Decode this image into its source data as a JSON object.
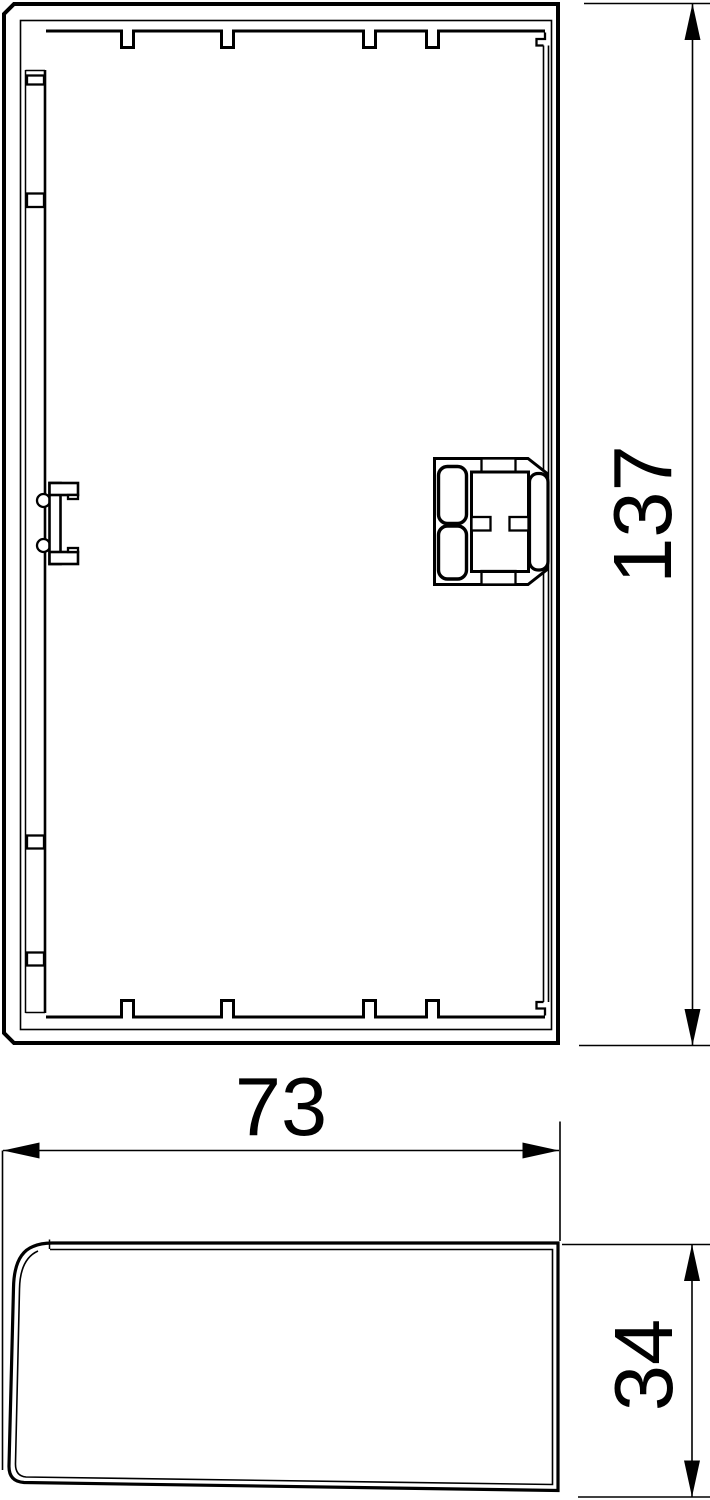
{
  "drawing": {
    "background_color": "#ffffff",
    "line_color": "#000000",
    "dimensions": {
      "height": "137",
      "width": "73",
      "depth": "34"
    }
  }
}
